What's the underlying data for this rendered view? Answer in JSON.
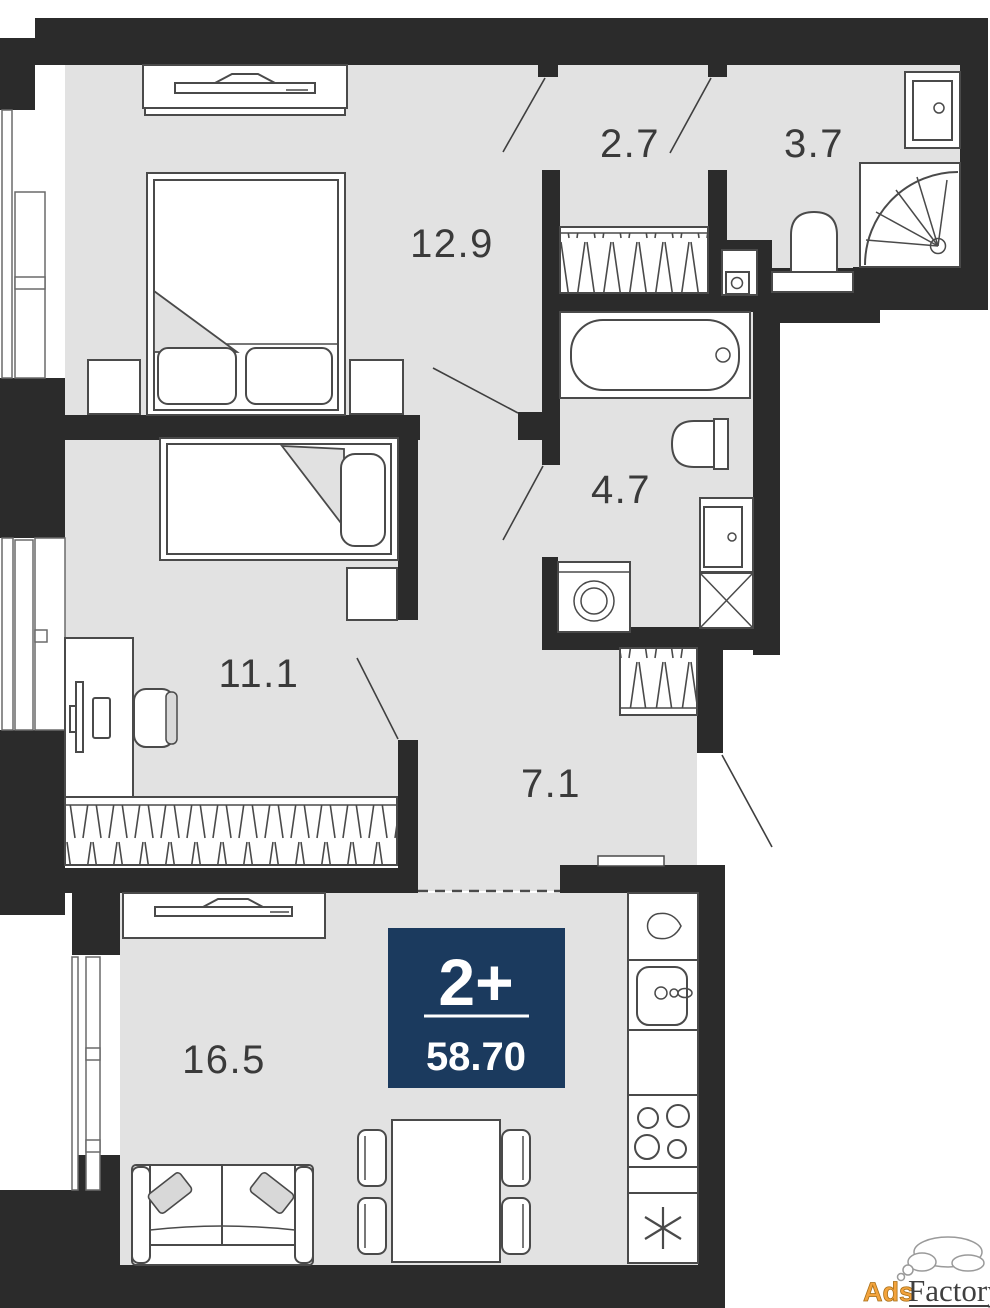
{
  "rooms": {
    "bedroom1": {
      "label": "12.9"
    },
    "hallway": {
      "label": "2.7"
    },
    "bathroom_small": {
      "label": "3.7"
    },
    "bathroom_big": {
      "label": "4.7"
    },
    "bedroom2": {
      "label": "11.1"
    },
    "corridor": {
      "label": "7.1"
    },
    "living_kitchen": {
      "label": "16.5"
    }
  },
  "badge": {
    "rooms_count": "2+",
    "total_area": "58.70"
  },
  "watermark": {
    "ads": "Ads",
    "factory": "Factory"
  },
  "colors": {
    "wall": "#2b2b2b",
    "floor": "#e2e2e2",
    "badge_bg": "#1b3a5e",
    "label_text": "#3a3a3a",
    "watermark_orange": "#f3a33c"
  }
}
